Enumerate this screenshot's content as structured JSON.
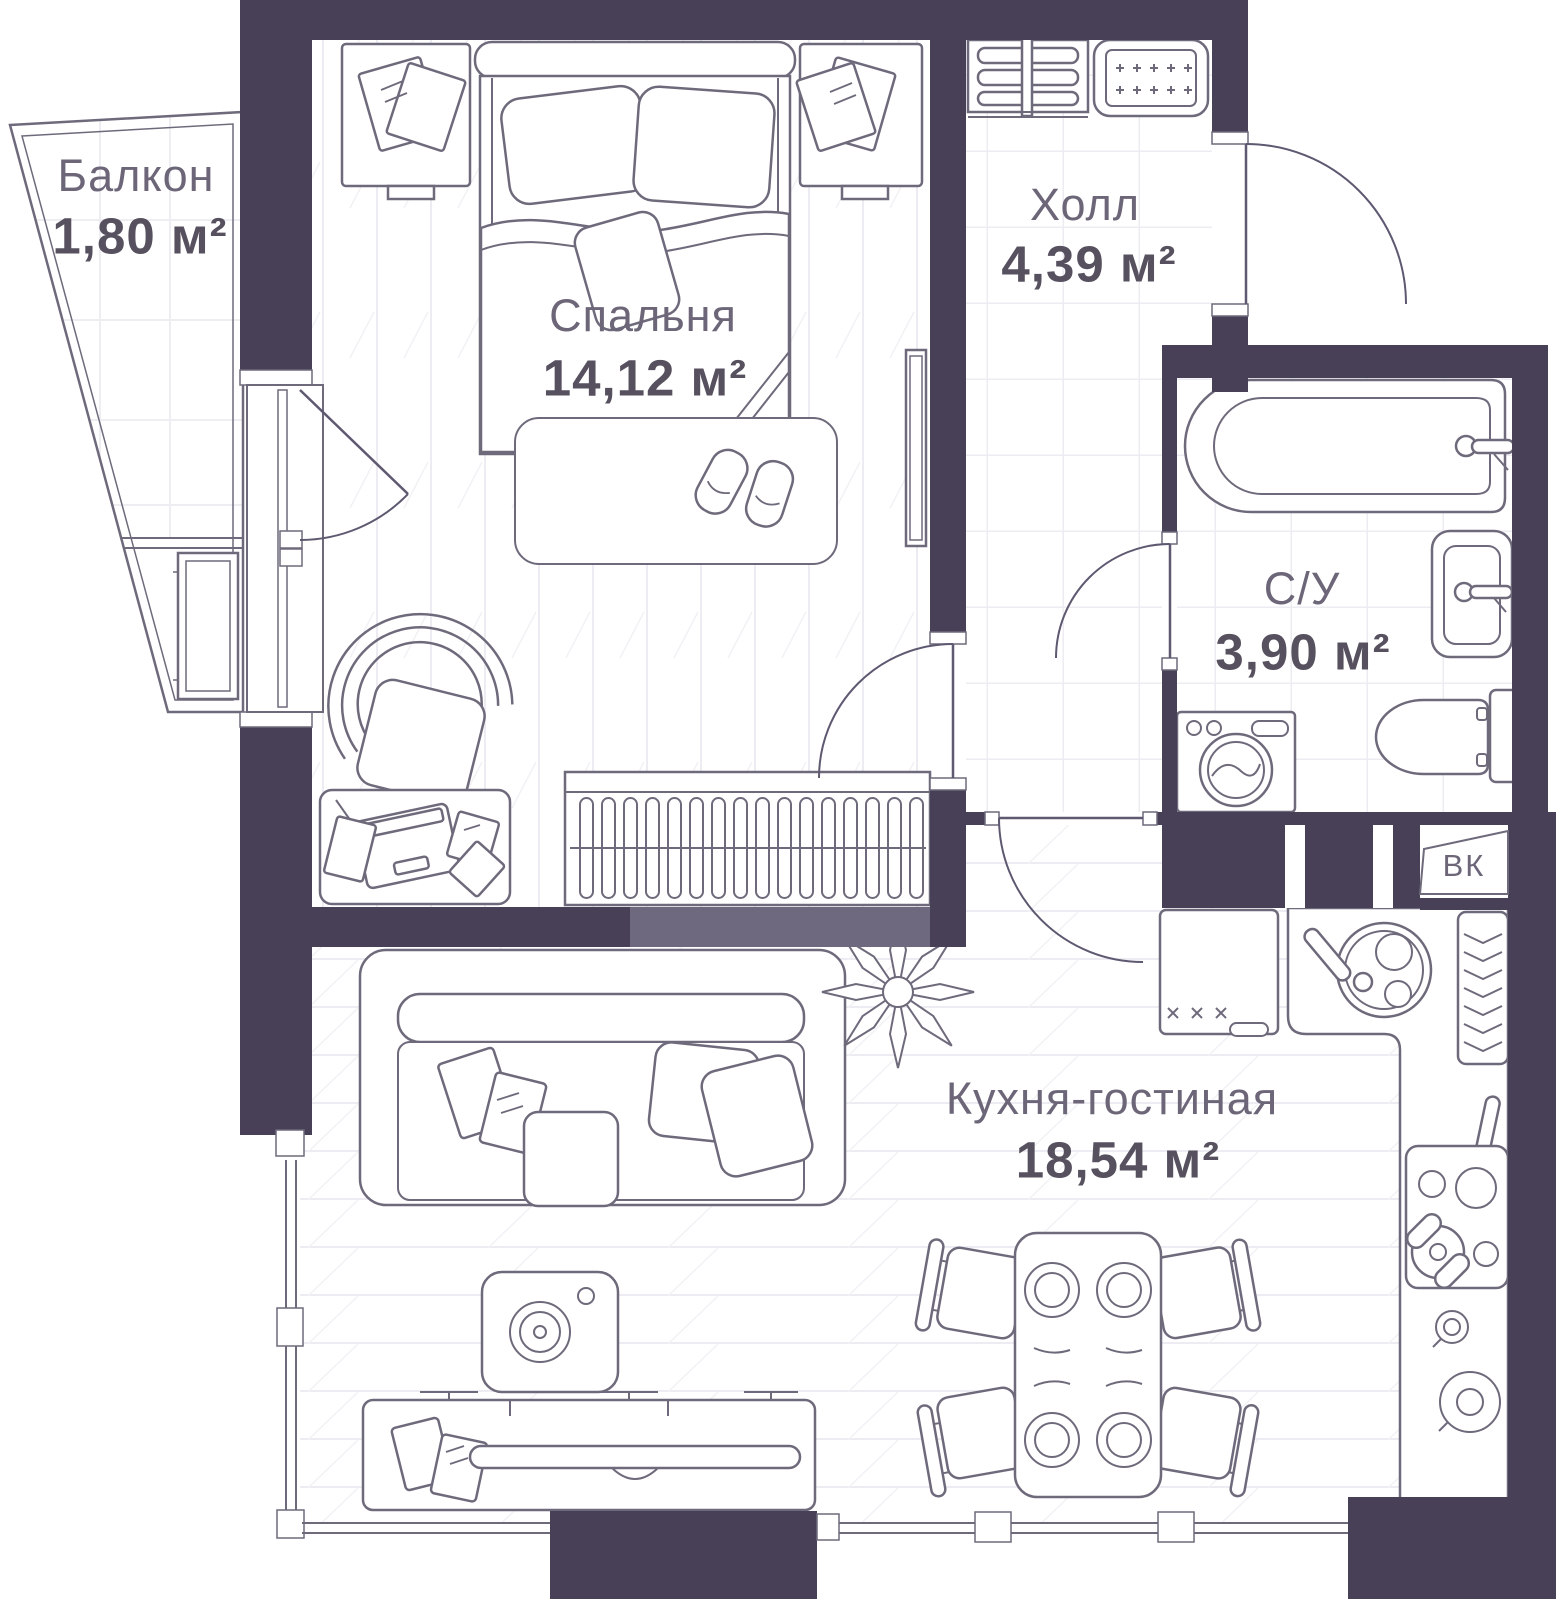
{
  "plan_type": "apartment-floor-plan",
  "rooms": {
    "balcony": {
      "name": "Балкон",
      "area": "1,80 м²"
    },
    "bedroom": {
      "name": "Спальня",
      "area": "14,12 м²"
    },
    "hall": {
      "name": "Холл",
      "area": "4,39 м²"
    },
    "bathroom": {
      "name": "С/У",
      "area": "3,90 м²"
    },
    "kitchen_living": {
      "name": "Кухня-гостиная",
      "area": "18,54 м²"
    }
  },
  "labels": {
    "duct": "ВК"
  },
  "colors": {
    "wall": "#474056",
    "wall_partition": "#6F6980",
    "outline": "#6F6A7B",
    "floor_line": "#ECECF2",
    "label_name": "#6C6678",
    "label_area": "#57515F",
    "background": "#FFFFFF"
  }
}
